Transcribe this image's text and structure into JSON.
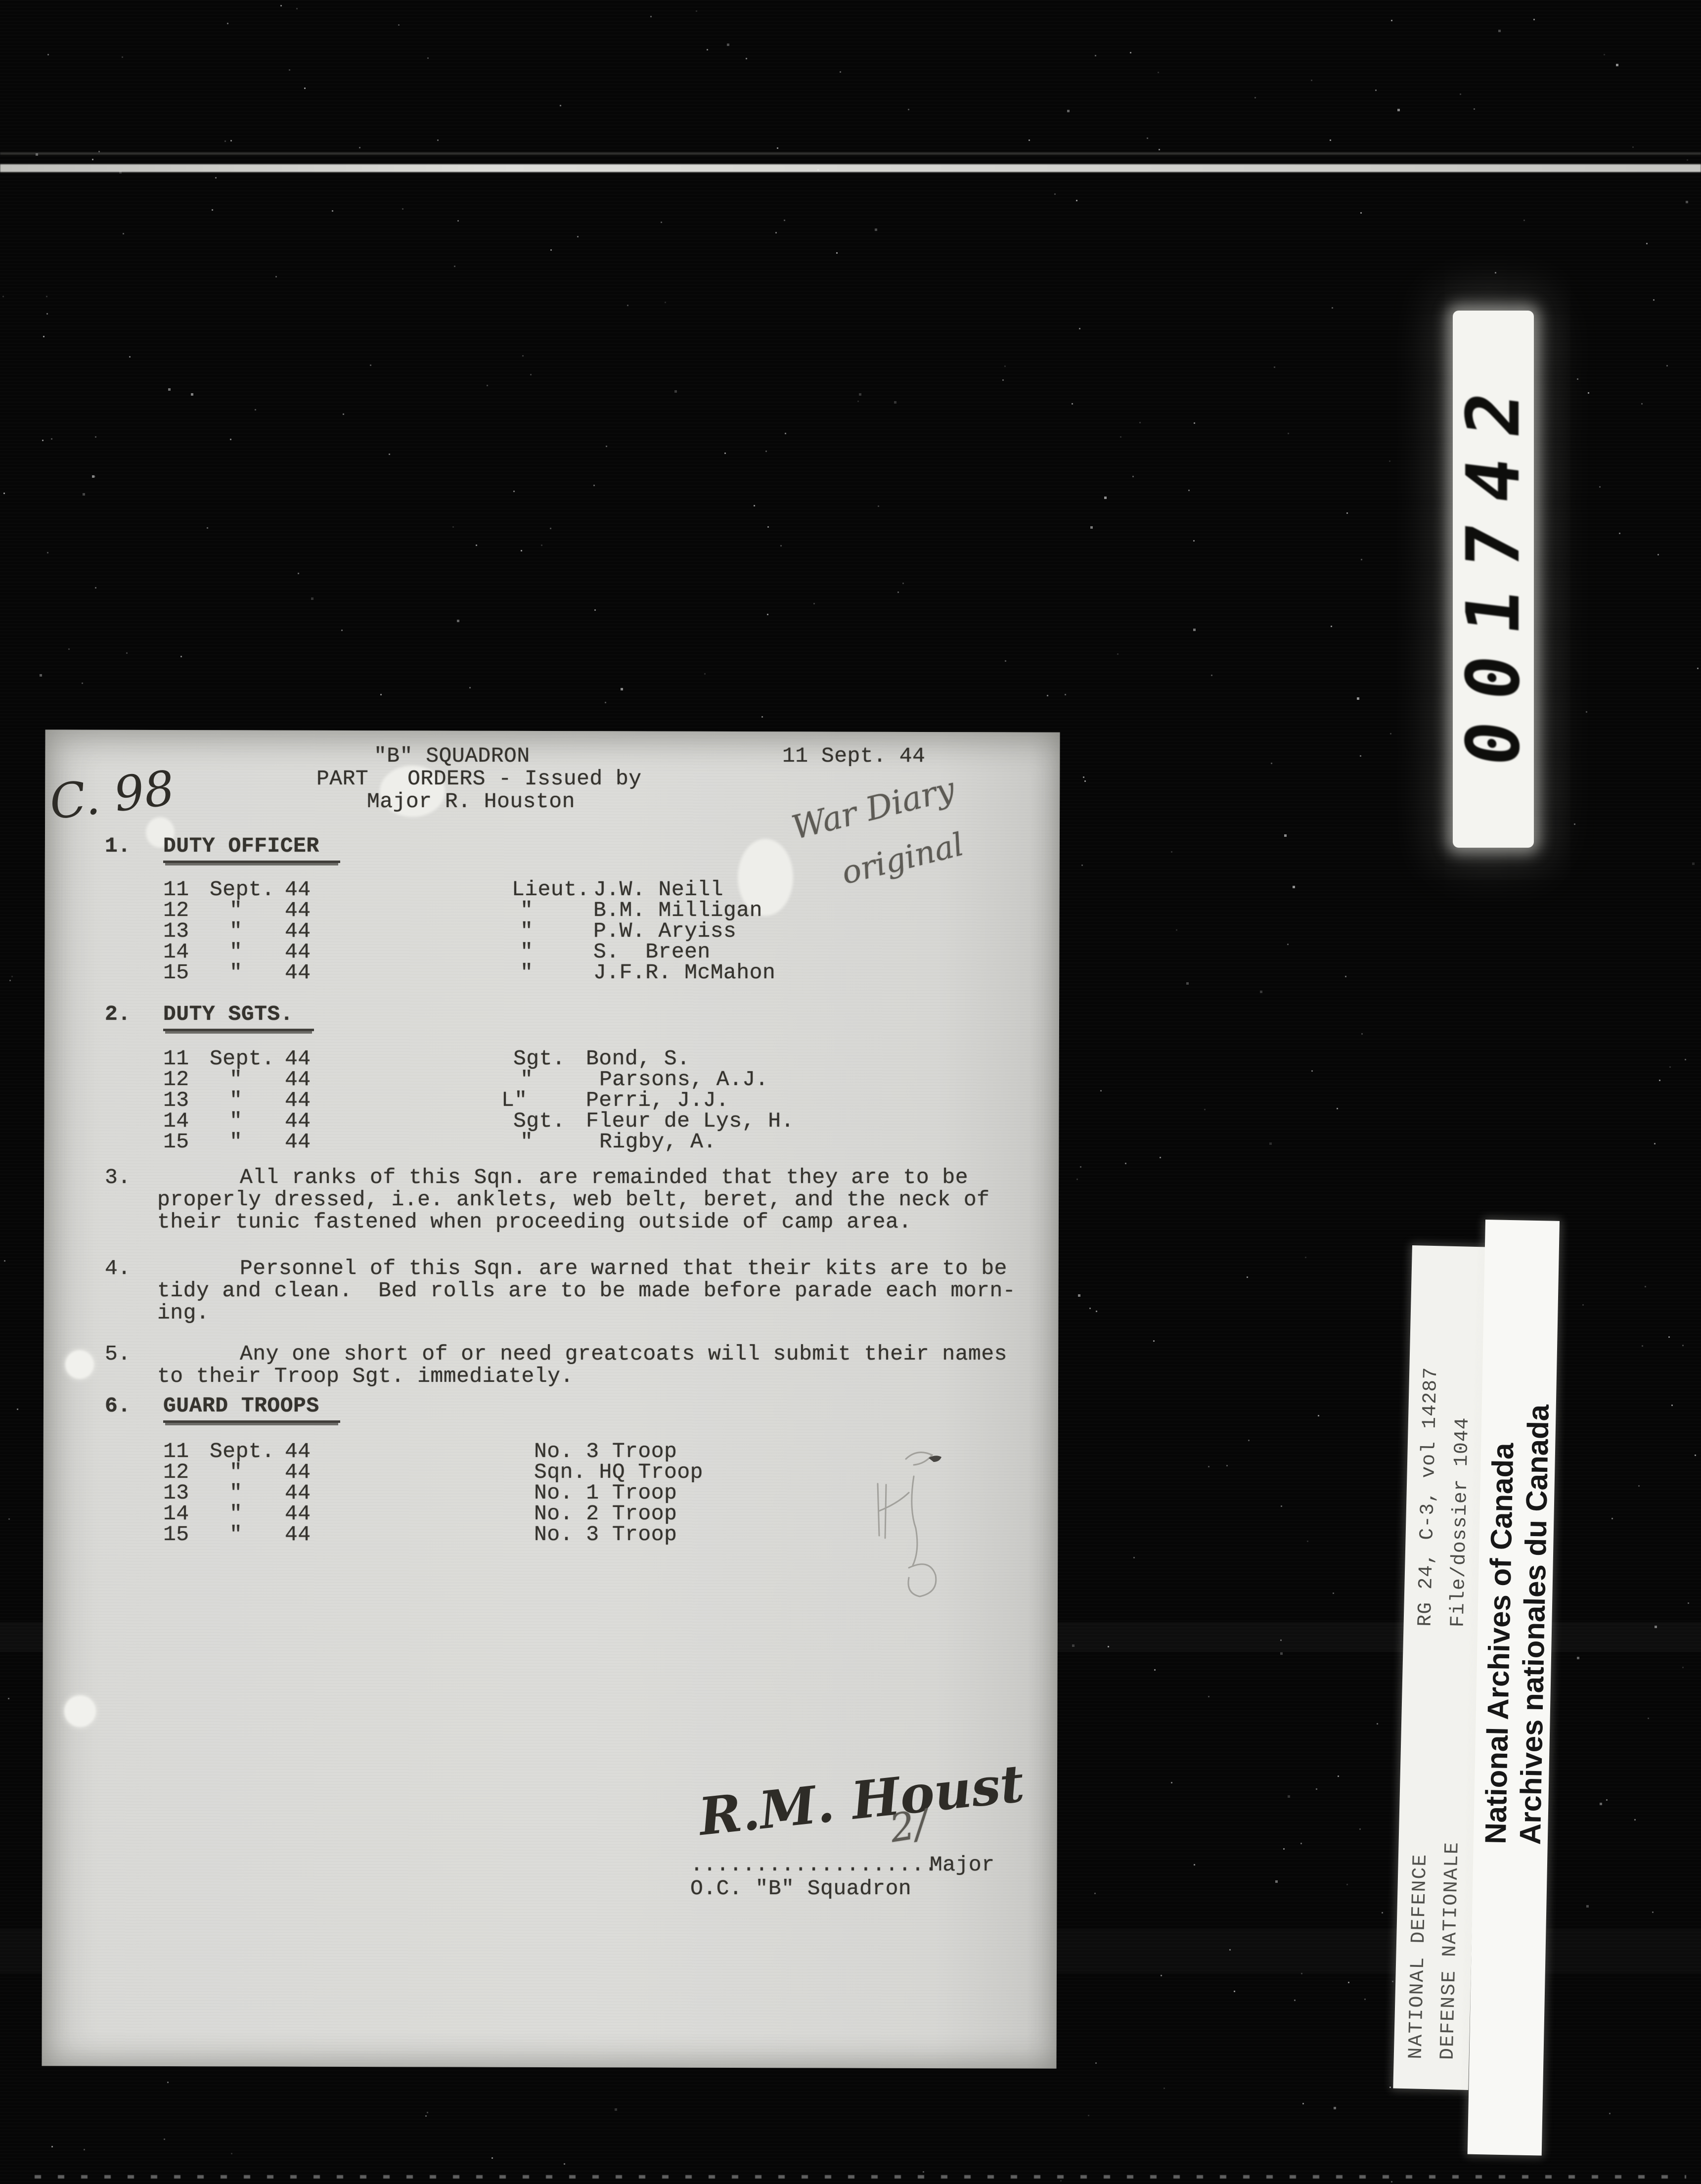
{
  "film": {
    "counter_digits": "001742",
    "strip_archive_ref": {
      "line1": "RG 24, C-3, vol 14287",
      "line2": "File/dossier 1044"
    },
    "strip_defence": {
      "line1": "NATIONAL DEFENCE",
      "line2": "DEFENSE NATIONALE"
    },
    "strip_archives": {
      "line1": "National Archives of Canada",
      "line2": "Archives nationales du Canada"
    }
  },
  "document": {
    "annotations": {
      "top_left": "C. 98",
      "war_diary_line1": "War Diary",
      "war_diary_line2": "original",
      "sig_overwrite": "2/"
    },
    "header": {
      "squadron": "\"B\" SQUADRON",
      "orders_line": "PART   ORDERS - Issued by",
      "issuer": "Major R. Houston",
      "date": "11 Sept. 44"
    },
    "sections": [
      {
        "num": "1.",
        "title": "DUTY OFFICER",
        "rows": [
          {
            "d": "11",
            "m": "Sept.",
            "y": "44",
            "rank": "Lieut.",
            "name": "J.W. Neill"
          },
          {
            "d": "12",
            "m": "\"",
            "y": "44",
            "rank": "\"",
            "name": "B.M. Milligan"
          },
          {
            "d": "13",
            "m": "\"",
            "y": "44",
            "rank": "\"",
            "name": "P.W. Aryiss"
          },
          {
            "d": "14",
            "m": "\"",
            "y": "44",
            "rank": "\"",
            "name": "S.  Breen"
          },
          {
            "d": "15",
            "m": "\"",
            "y": "44",
            "rank": "\"",
            "name": "J.F.R. McMahon"
          }
        ]
      },
      {
        "num": "2.",
        "title": "DUTY SGTS.",
        "rows": [
          {
            "d": "11",
            "m": "Sept.",
            "y": "44",
            "rank": "Sgt.",
            "name": "Bond, S."
          },
          {
            "d": "12",
            "m": "\"",
            "y": "44",
            "rank": "\"",
            "name": "Parsons, A.J."
          },
          {
            "d": "13",
            "m": "\"",
            "y": "44",
            "rank": "L\"",
            "name": "Perri, J.J."
          },
          {
            "d": "14",
            "m": "\"",
            "y": "44",
            "rank": "Sgt.",
            "name": "Fleur de Lys, H."
          },
          {
            "d": "15",
            "m": "\"",
            "y": "44",
            "rank": "\"",
            "name": "Rigby, A."
          }
        ]
      },
      {
        "num": "3.",
        "lines": [
          "All ranks of this Sqn. are remainded that they are to be",
          "properly dressed, i.e. anklets, web belt, beret, and the neck of",
          "their tunic fastened when proceeding outside of camp area."
        ]
      },
      {
        "num": "4.",
        "lines": [
          "Personnel of this Sqn. are warned that their kits are to be",
          "tidy and clean.  Bed rolls are to be made before parade each morn-",
          "ing."
        ]
      },
      {
        "num": "5.",
        "lines": [
          "Any one short of or need greatcoats will submit their names",
          "to their Troop Sgt. immediately."
        ]
      },
      {
        "num": "6.",
        "title": "GUARD TROOPS",
        "rows": [
          {
            "d": "11",
            "m": "Sept.",
            "y": "44",
            "unit": "No. 3 Troop"
          },
          {
            "d": "12",
            "m": "\"",
            "y": "44",
            "unit": "Sqn. HQ Troop"
          },
          {
            "d": "13",
            "m": "\"",
            "y": "44",
            "unit": "No. 1 Troop"
          },
          {
            "d": "14",
            "m": "\"",
            "y": "44",
            "unit": "No. 2 Troop"
          },
          {
            "d": "15",
            "m": "\"",
            "y": "44",
            "unit": "No. 3 Troop"
          }
        ]
      }
    ],
    "signature": {
      "script": "R.M. Houst",
      "dots": "...................",
      "rank": "Major",
      "oc_line": "O.C. \"B\" Squadron"
    }
  }
}
